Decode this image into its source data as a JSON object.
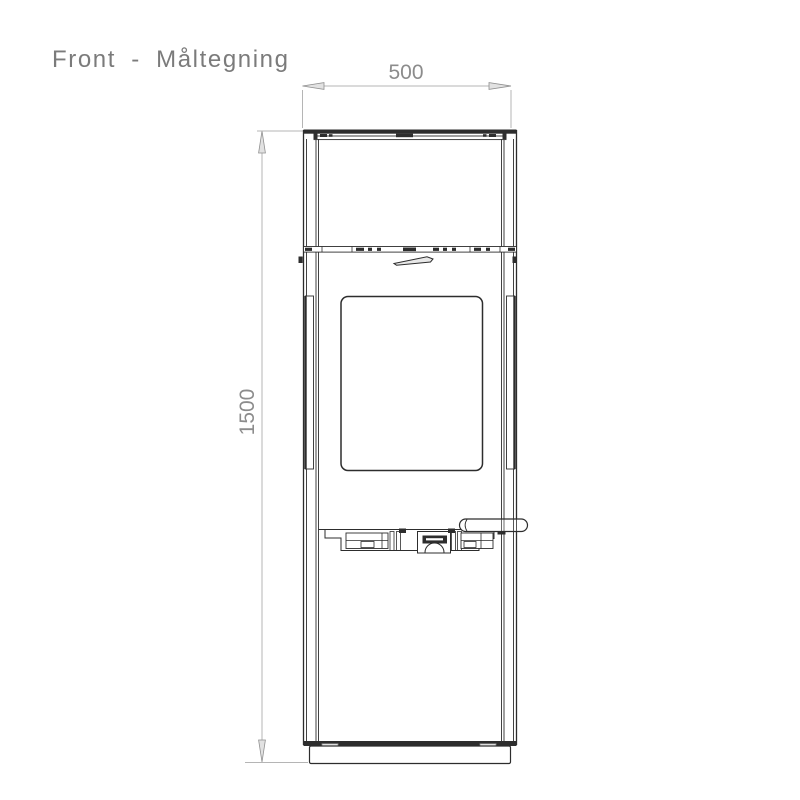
{
  "page": {
    "background_color": "#ffffff"
  },
  "header": {
    "title": "Front - Måltegning"
  },
  "drawing": {
    "subject": "stove-front-elevation",
    "view": "Front",
    "line_color": "#2d2d2d",
    "dimension_line_color": "#b5b5b5",
    "dimension_text_color": "#8c8c8c",
    "dimensions": {
      "width": {
        "value": "500",
        "orientation": "horizontal",
        "position": "top"
      },
      "height": {
        "value": "1500",
        "orientation": "vertical",
        "position": "left"
      }
    }
  }
}
